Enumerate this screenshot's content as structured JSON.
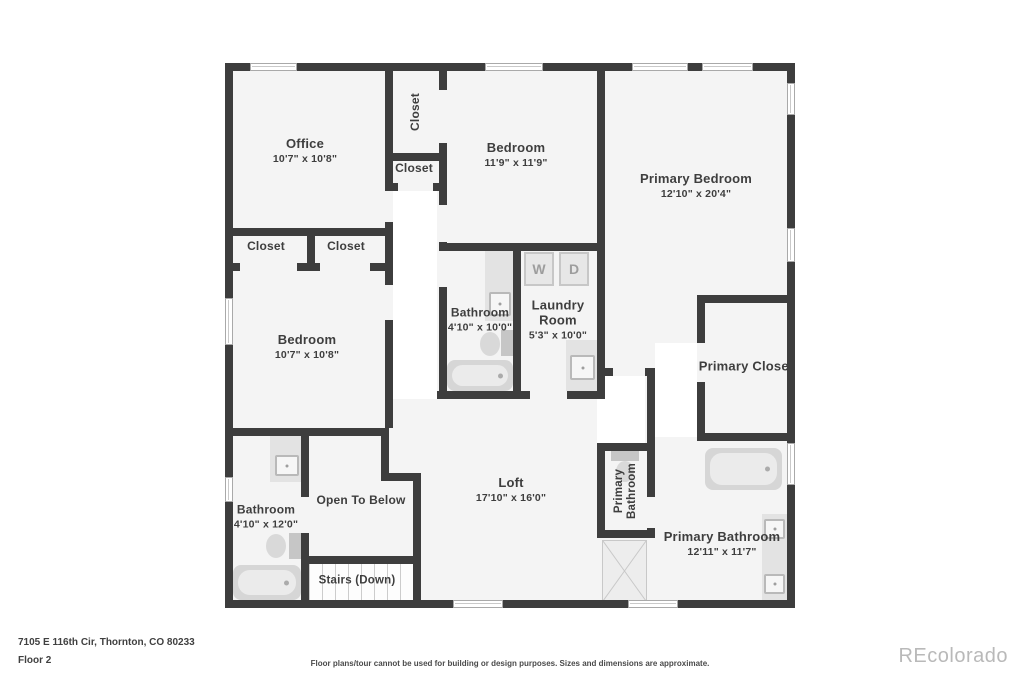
{
  "rooms": {
    "office": {
      "label": "Office",
      "dims": "10'7\" x 10'8\""
    },
    "closet_top": {
      "label": "Closet"
    },
    "closet_hall": {
      "label": "Closet"
    },
    "bedroom_top": {
      "label": "Bedroom",
      "dims": "11'9\" x 11'9\""
    },
    "primary_bedroom": {
      "label": "Primary Bedroom",
      "dims": "12'10\" x 20'4\""
    },
    "closet_a": {
      "label": "Closet"
    },
    "closet_b": {
      "label": "Closet"
    },
    "bedroom_left": {
      "label": "Bedroom",
      "dims": "10'7\" x 10'8\""
    },
    "bathroom_mid": {
      "label": "Bathroom",
      "dims": "4'10\" x 10'0\""
    },
    "laundry": {
      "label": "Laundry Room",
      "dims": "5'3\" x 10'0\""
    },
    "primary_closet": {
      "label": "Primary Closet"
    },
    "bathroom_bl": {
      "label": "Bathroom",
      "dims": "4'10\" x 12'0\""
    },
    "open_below": {
      "label": "Open To Below"
    },
    "stairs": {
      "label": "Stairs (Down)"
    },
    "loft": {
      "label": "Loft",
      "dims": "17'10\" x 16'0\""
    },
    "primary_bath_wc": {
      "label": "Primary Bathroom"
    },
    "primary_bathroom": {
      "label": "Primary Bathroom",
      "dims": "12'11\" x 11'7\""
    }
  },
  "appliances": {
    "washer": "W",
    "dryer": "D"
  },
  "footer": {
    "address": "7105 E 116th Cir, Thornton, CO 80233",
    "floor": "Floor 2",
    "disclaimer": "Floor plans/tour cannot be used for building or design purposes. Sizes and dimensions are approximate.",
    "watermark": "REcolorado"
  },
  "colors": {
    "wall": "#3d3d3d",
    "room_fill": "#f4f4f4",
    "fixture": "#d6d6d6",
    "label": "#3e3e3e"
  }
}
